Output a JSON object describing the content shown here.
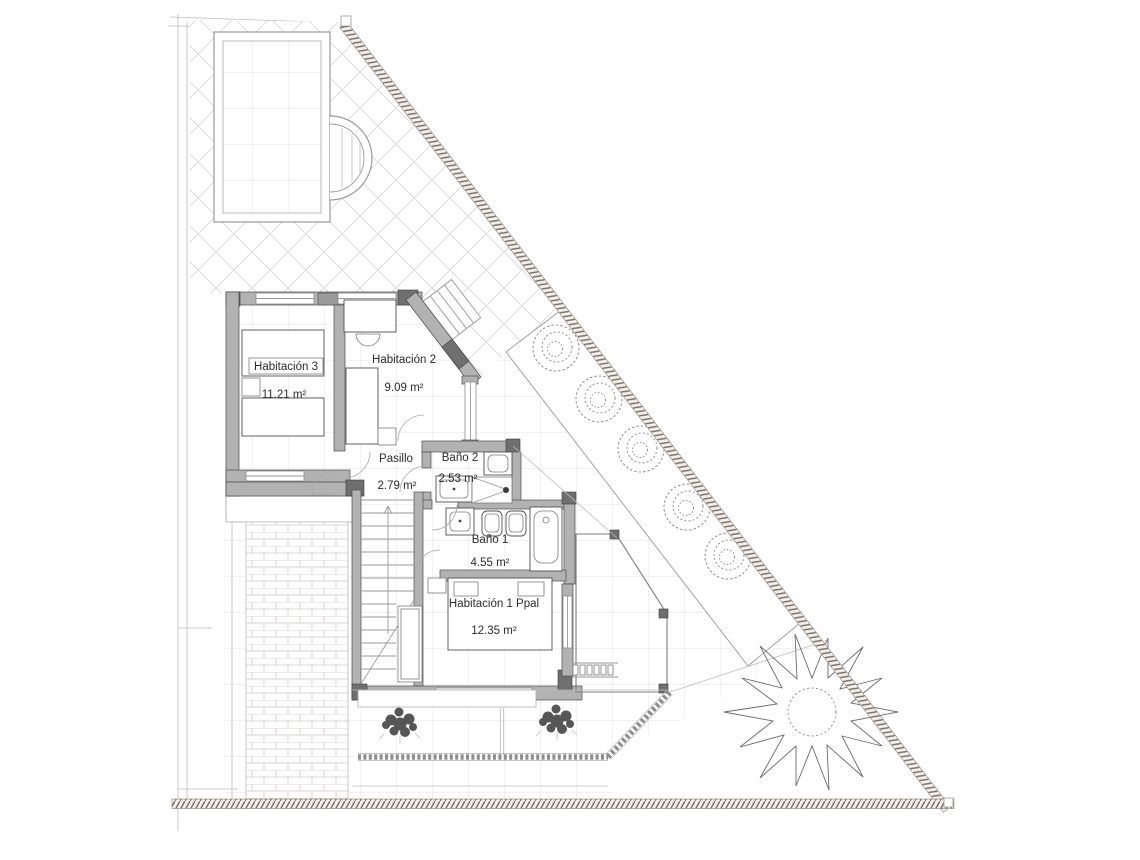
{
  "plan": {
    "type": "floor-plan",
    "rooms": [
      {
        "name": "Habitación 3",
        "area": "11.21 m²"
      },
      {
        "name": "Habitación 2",
        "area": "9.09 m²"
      },
      {
        "name": "Pasillo",
        "area": "2.79 m²"
      },
      {
        "name": "Baño 2",
        "area": "2.53 m²"
      },
      {
        "name": "Baño 1",
        "area": "4.55 m²"
      },
      {
        "name": "Habitación 1 Ppal",
        "area": "12.35 m²"
      }
    ],
    "colors": {
      "paper": "#ffffff",
      "wall_fill": "#b2b2b2",
      "pillar_fill": "#6f6f6f",
      "boundary_hatch": "#7b6e64",
      "tile_grid": "#e4e4e4",
      "vegetation_line": "#8f8f8f"
    }
  }
}
